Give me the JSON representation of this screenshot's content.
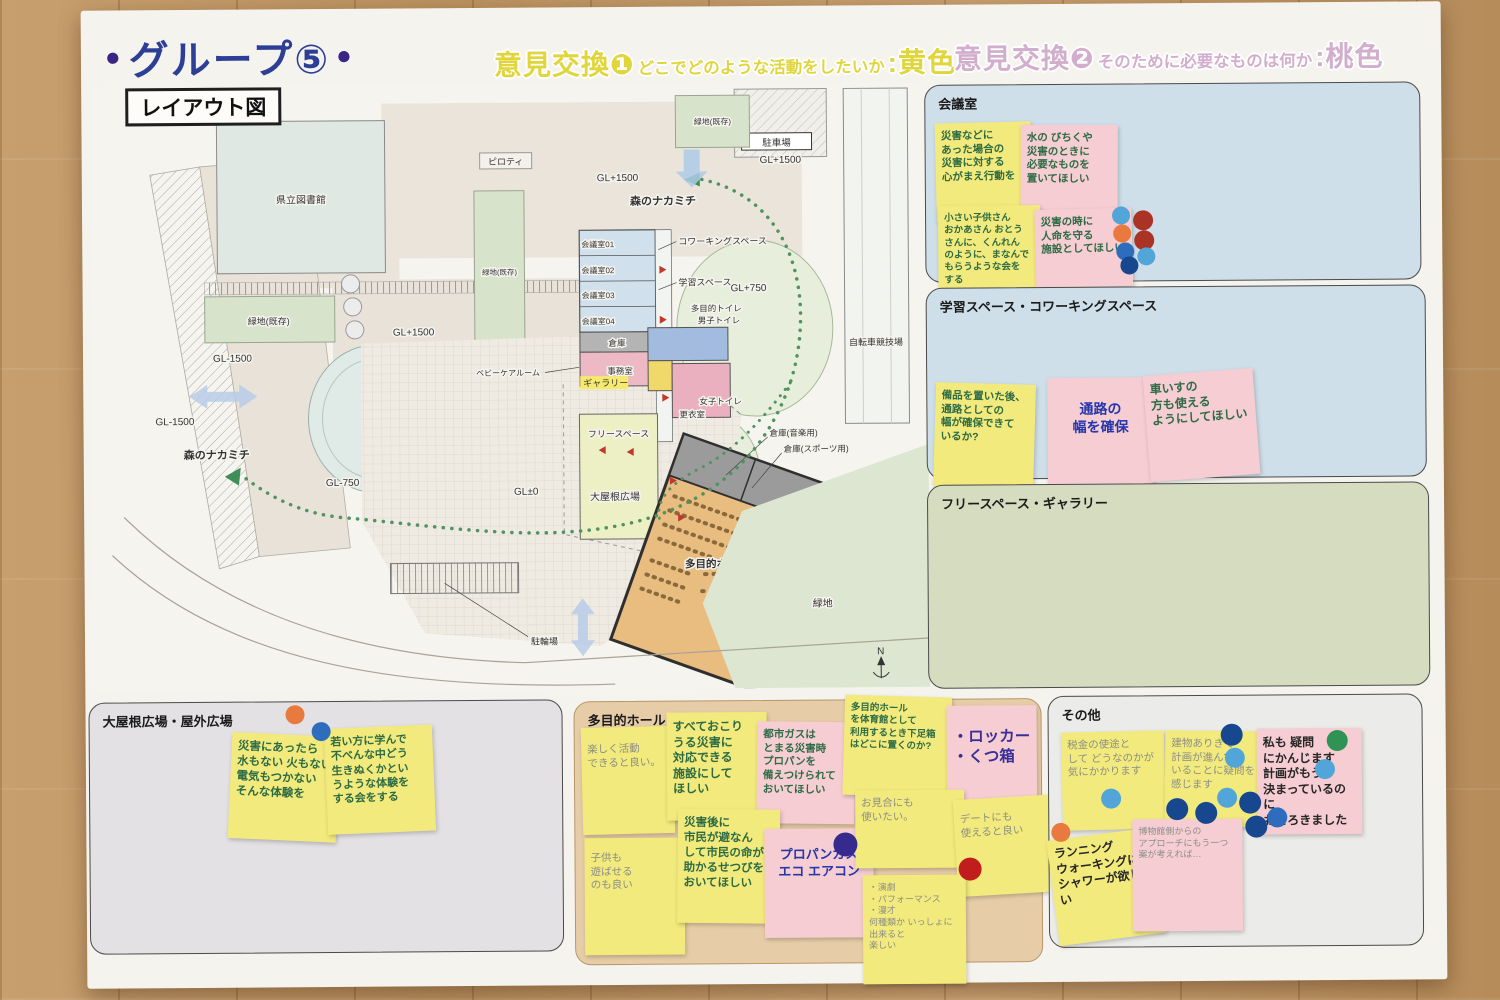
{
  "header": {
    "bullet": "●",
    "title": "グループ⑤",
    "exchange1": {
      "label": "意見交換❶",
      "question": "どこでどのような活動をしたいか",
      "color": ":黄色"
    },
    "exchange2": {
      "label": "意見交換❷",
      "question": "そのために必要なものは何か",
      "color": ":桃色"
    }
  },
  "map": {
    "title": "レイアウト図",
    "labels": {
      "library": "県立図書館",
      "green_existing": "緑地(既存)",
      "parking": "駐車場",
      "piloti": "ピロティ",
      "velodrome": "自転車競技場",
      "carry_in": "搬入動線",
      "gl_p1500": "GL+1500",
      "gl_m1500": "GL-1500",
      "gl_p750": "GL+750",
      "gl_m750": "GL-750",
      "gl_zero": "GL±0",
      "forest_path": "森のナカミチ",
      "meeting1": "会議室01",
      "meeting2": "会議室02",
      "meeting3": "会議室03",
      "meeting4": "会議室04",
      "coworking": "コワーキングスペース",
      "study": "学習スペース",
      "multi_toilet": "多目的トイレ",
      "men_toilet": "男子トイレ",
      "storage": "倉庫",
      "office": "事務室",
      "gallery": "ギャラリー",
      "women_toilet": "女子トイレ",
      "changing": "更衣室",
      "free_space": "フリースペース",
      "storage_music": "倉庫(音楽用)",
      "storage_sports": "倉庫(スポーツ用)",
      "plaza": "大屋根広場",
      "hall": "多目的ホール",
      "green": "緑地",
      "bicycle_parking": "駐輪場",
      "baby_care": "ベビーケアルーム",
      "north": "N"
    }
  },
  "sections": {
    "kaigishitsu": {
      "label": "会議室"
    },
    "gakushu": {
      "label": "学習スペース・コワーキングスペース"
    },
    "free_gallery": {
      "label": "フリースペース・ギャラリー"
    },
    "oyane": {
      "label": "大屋根広場・屋外広場"
    },
    "tamokuteki": {
      "label": "多目的ホール"
    },
    "sonota": {
      "label": "その他"
    }
  },
  "notes": {
    "kaigishitsu": [
      {
        "color": "yellow",
        "ink": "green",
        "text": "災害などに\nあった場合の\n災害に対する\n心がまえ行動を"
      },
      {
        "color": "pink",
        "ink": "green",
        "text": "水の びちくや\n災害のときに\n必要なものを\n置いてほしい"
      },
      {
        "color": "yellow",
        "ink": "green",
        "text": "小さい子供さん\nおかあさん おとう\nさんに、くんれん\nのように、まなんで\nもらうような会を\nする"
      },
      {
        "color": "pink",
        "ink": "green",
        "text": "災害の時に\n人命を守る\n施設としてほしい"
      }
    ],
    "gakushu": [
      {
        "color": "yellow",
        "ink": "green",
        "text": "備品を置いた後、\n通路としての\n幅が確保できて\nいるか?"
      },
      {
        "color": "pink",
        "ink": "blue",
        "text": "通路の\n幅を確保"
      },
      {
        "color": "pink",
        "ink": "green",
        "text": "車いすの\n方も使える\nようにしてほしい"
      }
    ],
    "oyane": [
      {
        "color": "yellow",
        "ink": "green",
        "text": "災害にあったら\n水もない 火もない\n電気もつかない\nそんな体験を"
      },
      {
        "color": "yellow",
        "ink": "green",
        "text": "若い方に学んで\n不べんな中どう\n生きぬくかとい\nうような体験を\nする会をする"
      }
    ],
    "tamokuteki": [
      {
        "color": "yellow",
        "ink": "pencil",
        "text": "楽しく活動\nできると良い。"
      },
      {
        "color": "yellow",
        "ink": "green",
        "text": "すべておこり\nうる災害に\n対応できる\n施設にして\nほしい"
      },
      {
        "color": "pink",
        "ink": "green",
        "text": "都市ガスは\nとまる災害時\nプロパンを\n備えつけられて\nおいてほしい"
      },
      {
        "color": "yellow",
        "ink": "green",
        "text": "多目的ホール\nを体育館として\n利用するとき下足箱\nはどこに置くのか?"
      },
      {
        "color": "pink",
        "ink": "purple",
        "text": "・ロッカー\n・くつ箱"
      },
      {
        "color": "yellow",
        "ink": "pencil",
        "text": "子供も\n遊ばせる\nのも良い"
      },
      {
        "color": "yellow",
        "ink": "green",
        "text": "災害後に\n市民が避なん\nして市民の命が\n助かるせつびを\nおいてほしい"
      },
      {
        "color": "pink",
        "ink": "blue",
        "text": "プロパンガス\nエコ エアコン"
      },
      {
        "color": "yellow",
        "ink": "pencil",
        "text": "お見合にも\n使いたい。"
      },
      {
        "color": "yellow",
        "ink": "pencil",
        "text": "デートにも\n使えると良い"
      },
      {
        "color": "yellow",
        "ink": "pencil",
        "text": "・演劇\n・パフォーマンス\n・漫才\n何種類か いっしょに\n出来ると\n楽しい"
      }
    ],
    "sonota": [
      {
        "color": "yellow",
        "ink": "pencil",
        "text": "税金の使途と\nして どうなのかが\n気にかかります"
      },
      {
        "color": "yellow",
        "ink": "pencil",
        "text": "建物ありきで\n計画が進んで\nいることに疑問を\n感じます"
      },
      {
        "color": "pink",
        "ink": "black",
        "text": "私も 疑問\nにかんじます\n計画がもう\n決まっているのに\nおどろきました"
      },
      {
        "color": "yellow",
        "ink": "black",
        "text": "ランニング\nウォーキングに\nシャワーが欲しい"
      },
      {
        "color": "pink",
        "ink": "pencil",
        "text": "博物館側からの\nアプローチにもう一つ\n案が考えれば…"
      }
    ]
  },
  "dots": {
    "kaigishitsu": [
      "lightblue",
      "darkred",
      "orange",
      "darkred",
      "blue",
      "lightblue",
      "darkblue"
    ],
    "oyane": [
      "orange",
      "blue"
    ],
    "tamokuteki": [
      "purple",
      "red"
    ],
    "sonota": [
      "lightblue",
      "darkblue",
      "lightblue",
      "darkblue",
      "darkblue",
      "lightblue",
      "darkblue",
      "green",
      "lightblue",
      "darkblue",
      "blue",
      "orange"
    ]
  },
  "colors": {
    "title_blue": "#2c3e96",
    "accent_purple": "#3a2587",
    "exchange1_yellow": "#e0d53a",
    "exchange2_pink": "#d2aecd",
    "note_yellow": "#f2ea7c",
    "note_pink": "#f5cdd2",
    "dot_lightblue": "#51a5d8",
    "dot_blue": "#2e6dbd",
    "dot_darkblue": "#17478f",
    "dot_darkred": "#aa3325",
    "dot_red": "#c21d1d",
    "dot_orange": "#e8793f",
    "dot_green": "#2f9356",
    "dot_purple": "#372a8f",
    "forest_path_green": "#3f8e58"
  }
}
